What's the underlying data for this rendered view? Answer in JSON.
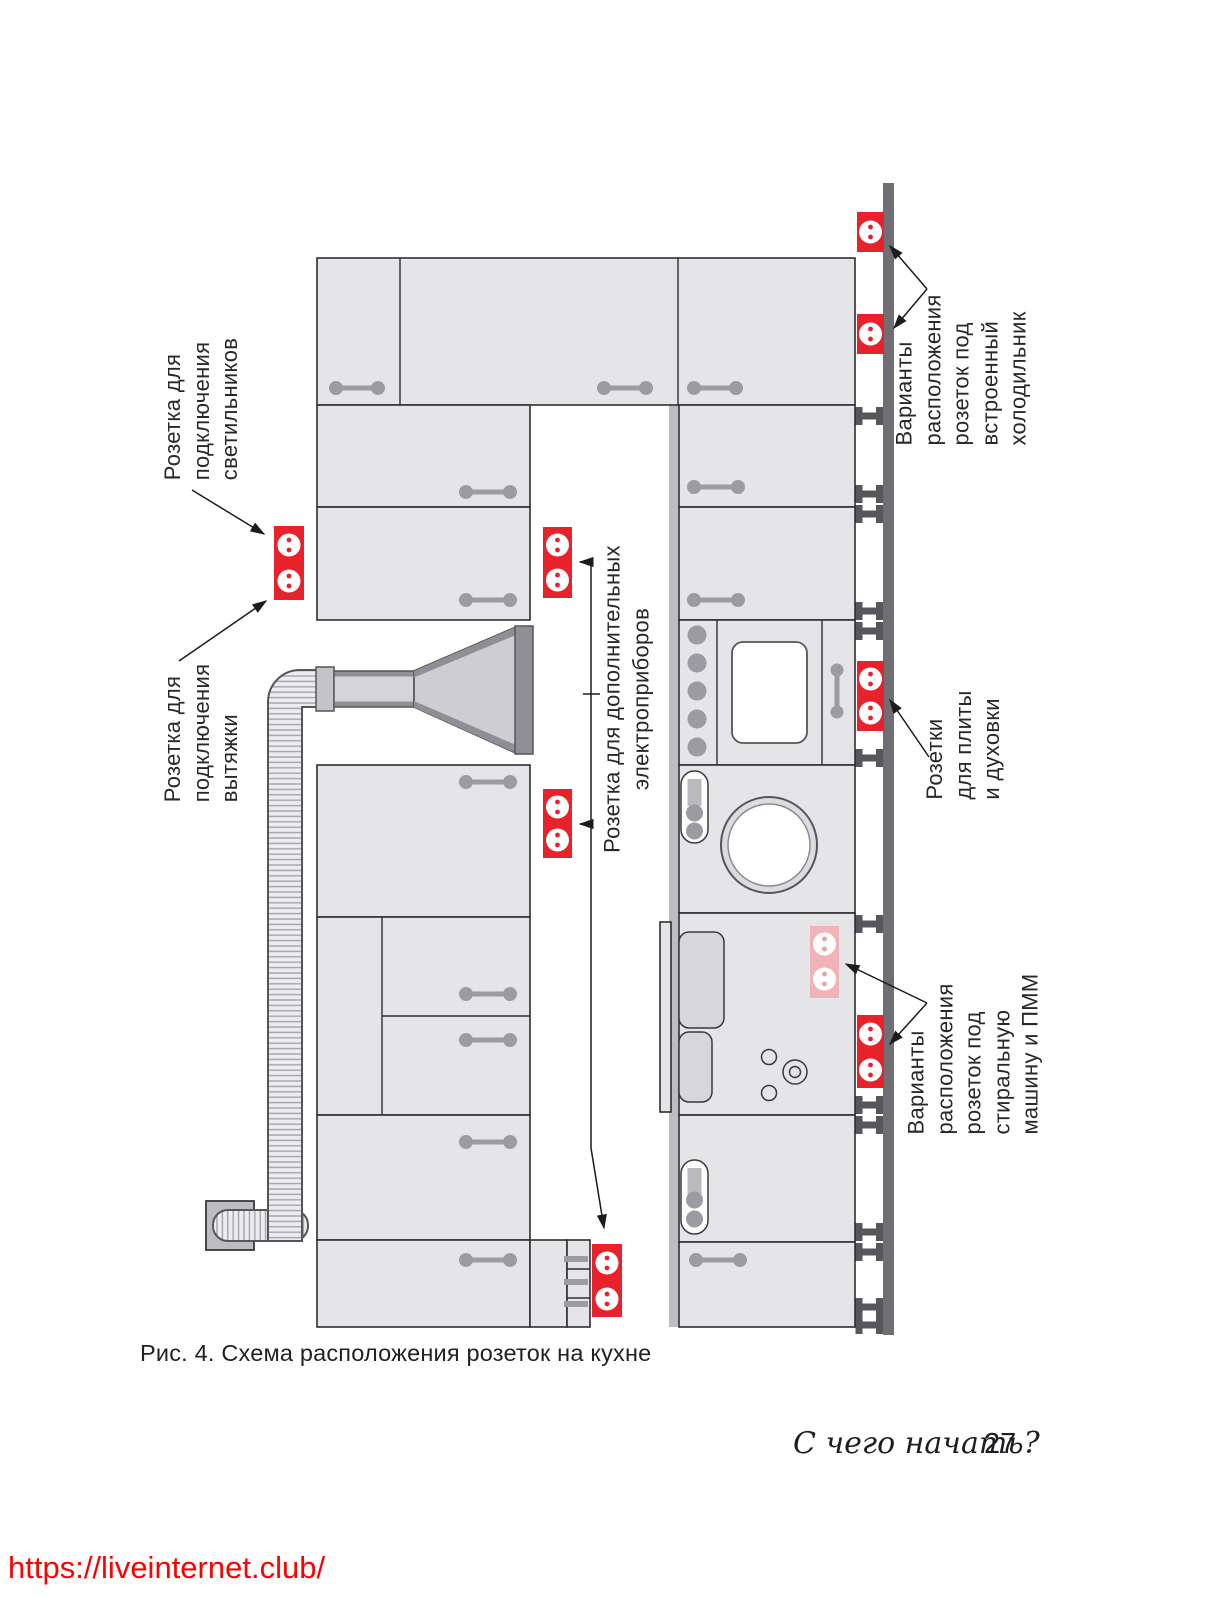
{
  "figure": {
    "caption": "Рис. 4. Схема расположения розеток на кухне",
    "annotations": {
      "lights": "Розетка для\nподключения\nсветильников",
      "hood": "Розетка для\nподключения\nвытяжки",
      "extra_appliances": "Розетка для дополнительных\nэлектроприборов",
      "stove_oven": "Розетки\nдля плиты\nи духовки",
      "fridge": "Варианты расположения\nрозеток под встроенный\nхолодильник",
      "washer_dishwasher": "Варианты расположения\nрозеток под стиральную\nмашину и ПММ"
    },
    "sockets": [
      {
        "name": "fridge-socket-option-1",
        "type": "single",
        "state": "active"
      },
      {
        "name": "fridge-socket-option-2",
        "type": "single",
        "state": "active"
      },
      {
        "name": "lights-socket",
        "type": "double",
        "state": "active"
      },
      {
        "name": "extra-appliances-socket-1",
        "type": "double",
        "state": "active"
      },
      {
        "name": "extra-appliances-socket-2",
        "type": "double",
        "state": "active"
      },
      {
        "name": "extra-appliances-socket-3",
        "type": "double",
        "state": "active"
      },
      {
        "name": "stove-oven-socket",
        "type": "double",
        "state": "active"
      },
      {
        "name": "washer-socket-option-faded",
        "type": "double",
        "state": "alternative"
      },
      {
        "name": "washer-socket-option-main",
        "type": "double",
        "state": "active"
      }
    ]
  },
  "footer": {
    "running_title": "С чего начать?",
    "page_number": "27"
  },
  "watermark": {
    "url": "https://liveinternet.club/"
  },
  "colors": {
    "socket_red": "#e8222b",
    "socket_faded_pink": "#f0b4b8",
    "wall_strip": "#6e6e73",
    "cabinet_fill": "#e5e5e8",
    "url_red": "#ff0000"
  }
}
